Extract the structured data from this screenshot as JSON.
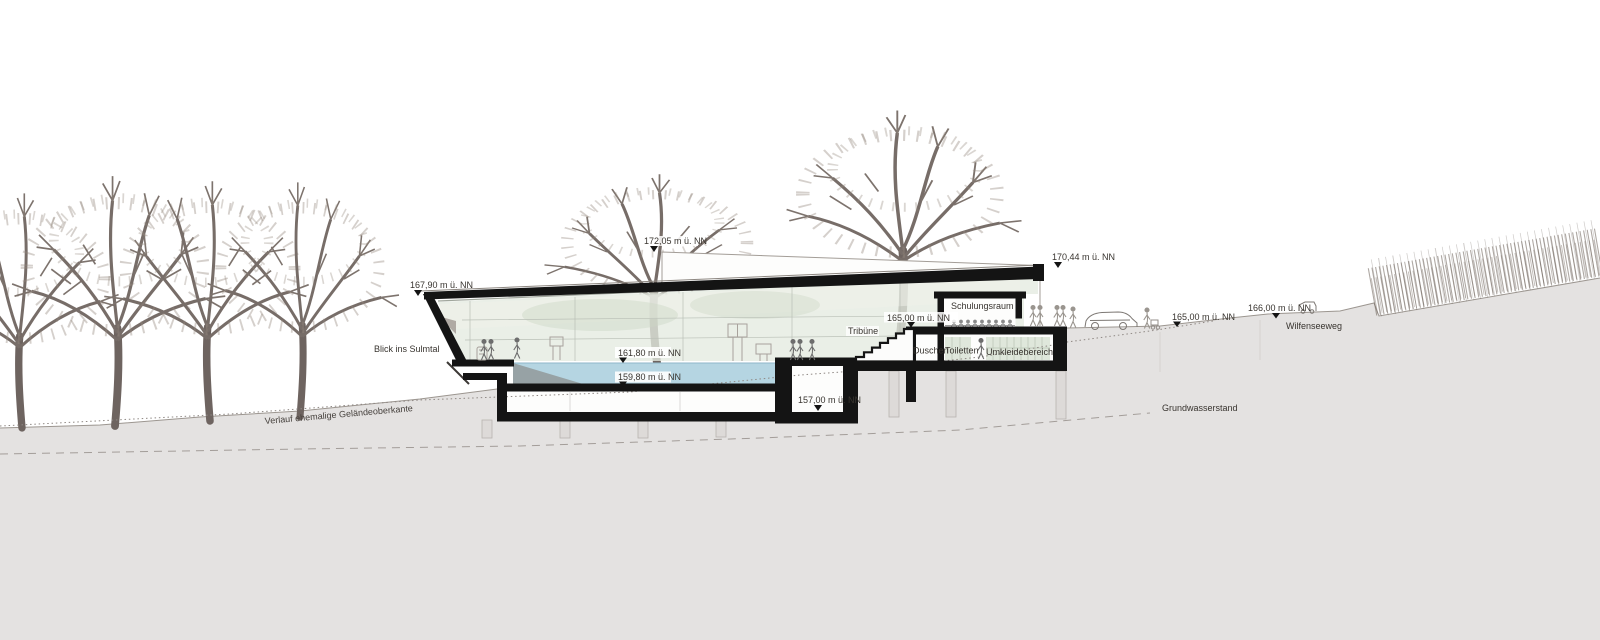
{
  "markers": {
    "roof_left": "167,90 m ü. NN",
    "skylight_top": "172,05 m ü. NN",
    "roof_right": "170,44 m ü. NN",
    "water_level": "161,80 m ü. NN",
    "pool_floor": "159,80 m ü. NN",
    "upper_floor": "165,00 m ü. NN",
    "basement": "157,00 m ü. NN",
    "terrain": "165,00 m ü. NN",
    "path_level": "166,00 m ü. NN"
  },
  "labels": {
    "view": "Blick ins Sulmtal",
    "tribune": "Tribüne",
    "training": "Schulungsraum",
    "showers": "Duschen",
    "toilets": "Toiletten",
    "changing": "Umkleidebereich",
    "path_name": "Wilfenseeweg",
    "groundwater": "Grundwasserstand",
    "former_grade": "Verlauf ehemalige Geländeoberkante"
  },
  "colors": {
    "water": "#b5d5e2",
    "glass": "#e6ece2",
    "ground": "#e4e2e1",
    "structure": "#141414",
    "pool_ramp": "#97a2a5"
  }
}
